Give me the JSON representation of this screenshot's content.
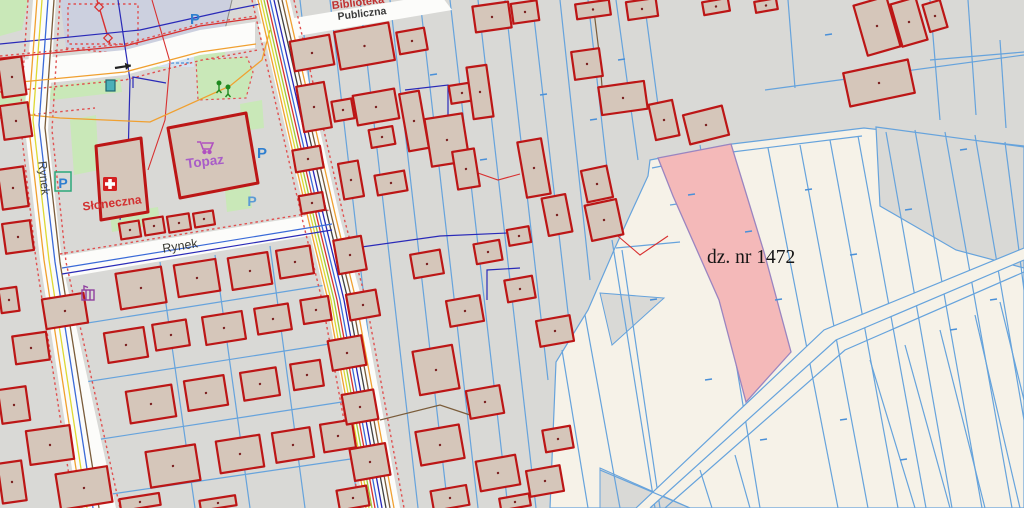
{
  "map": {
    "title": "Cadastral GIS map with highlighted parcel",
    "highlighted_parcel": {
      "label": "dz. nr 1472",
      "fill": "#f4b9b9"
    },
    "labels": {
      "store": "Topaz",
      "pharmacy_street": "Słoneczna",
      "street_rynek_vertical": "Rynek",
      "street_rynek": "Rynek",
      "top_edge_line1": "Biblioteka",
      "top_edge_line2": "Publiczna",
      "parking_letter": "P"
    },
    "icons": [
      "parking-icon",
      "shopping-cart-icon",
      "pharmacy-cross-icon",
      "one-way-arrow-icon",
      "playground-icon",
      "monument-icon",
      "utility-box-icon"
    ],
    "colors": {
      "background_gray": "#d9d9d6",
      "field_cream": "#f6f2e8",
      "parcel_line_blue": "#66a3dc",
      "building_fill": "#d5c6ba",
      "building_outline": "#bc1616",
      "highlight_pink": "#f4b9b9",
      "road_white": "#fcfcfa",
      "green_area": "#c9e8b8",
      "parking_area_lavender": "#ccd0df",
      "store_label_purple": "#a85cc8",
      "street_label_red": "#d23030"
    }
  }
}
